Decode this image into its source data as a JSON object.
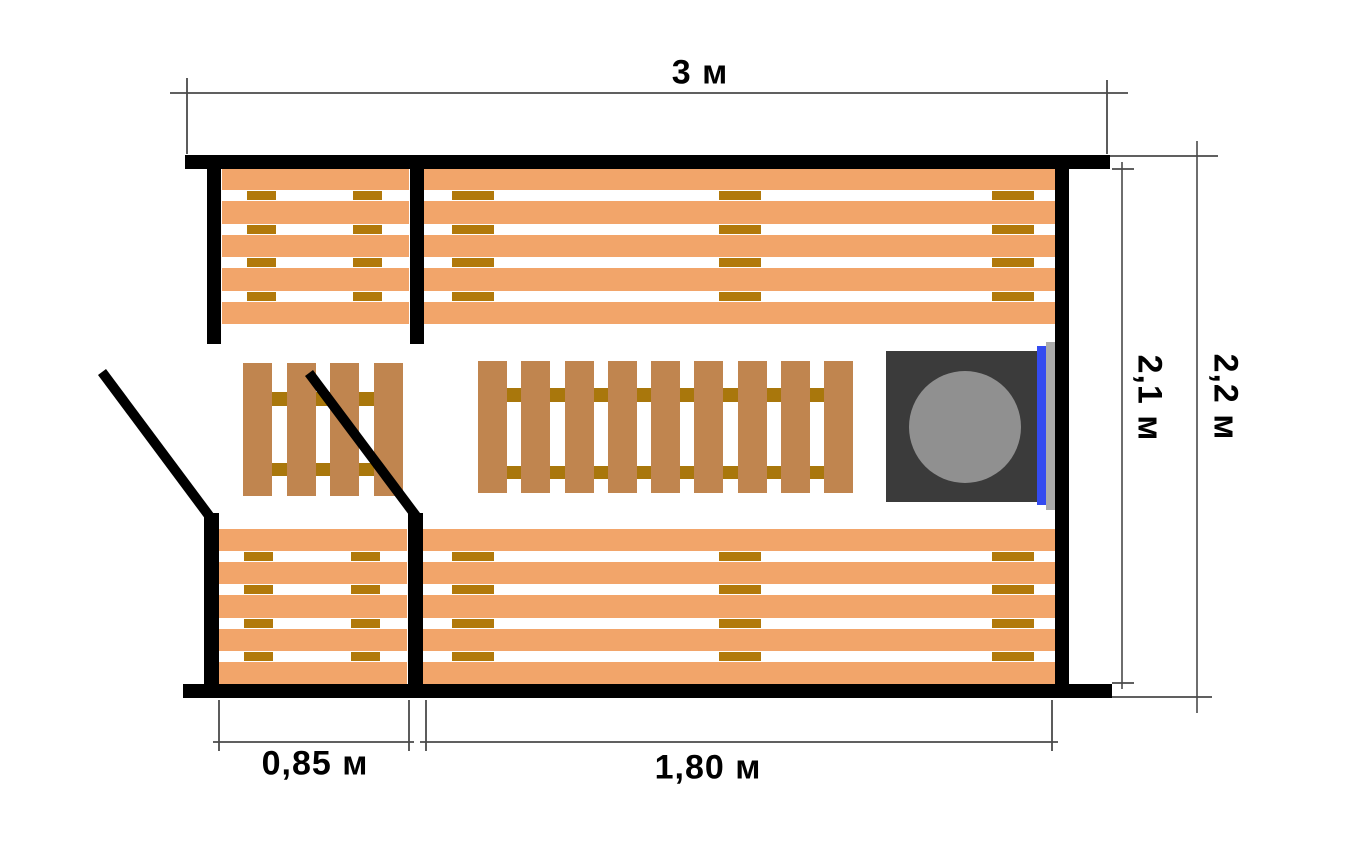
{
  "dimensions": {
    "overall_width": {
      "label": "3 м"
    },
    "inner_height": {
      "label": "2,1 м"
    },
    "outer_height": {
      "label": "2,2 м"
    },
    "vestibule_width": {
      "label": "0,85 м"
    },
    "steam_room_width": {
      "label": "1,80 м"
    }
  },
  "structure": {
    "bench_plank_count": 5,
    "floor_grate_left_plank_count": 4,
    "floor_grate_main_plank_count": 9,
    "grate_tie_rows": 2
  },
  "colors": {
    "wall": "#000000",
    "bench_plank": "#F2A56A",
    "bench_tie": "#B1790B",
    "grate_plank": "#C0854F",
    "grate_tie": "#A9770C",
    "stove_body": "#3B3B3B",
    "stove_lid": "#909090",
    "stove_trim": "#344BF0",
    "heat_shield": "#ABABAB",
    "dim_line": "#4A4A4A",
    "text": "#000000"
  }
}
